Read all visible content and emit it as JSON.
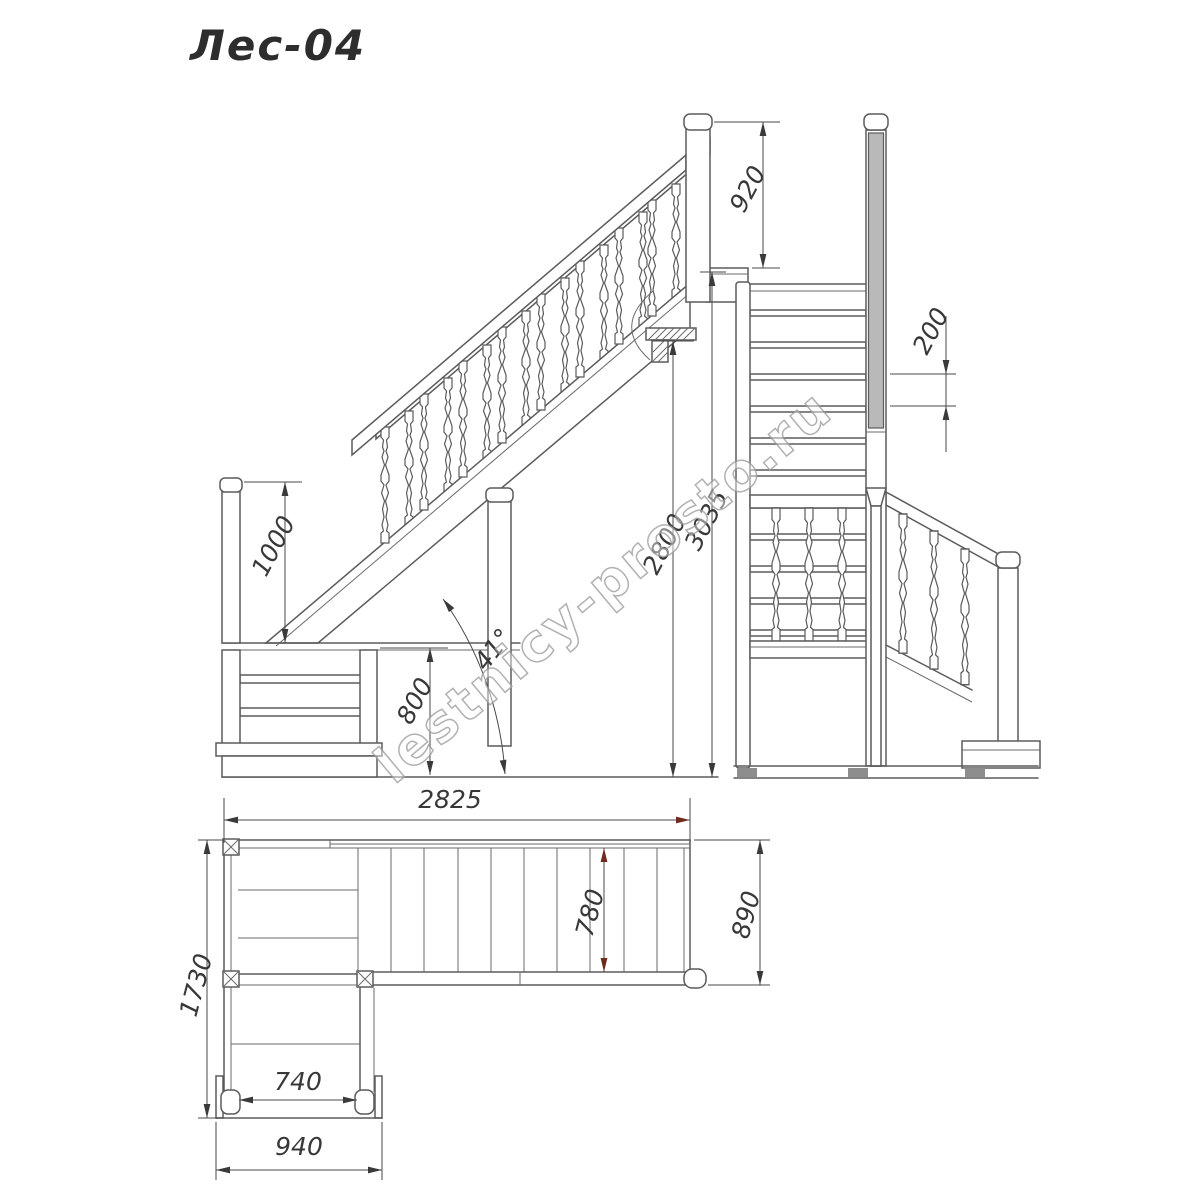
{
  "title": "Лес-04",
  "watermark": "lestnicy-prosto.ru",
  "dims": {
    "run_total": "2825",
    "newel_height": "920",
    "riser": "200",
    "rail_height": "1000",
    "landing_height": "800",
    "floor_clearance": "2800",
    "floor_top": "3035",
    "angle": "41°",
    "plan_depth": "1730",
    "lower_flight_inner": "740",
    "lower_flight_outer": "940",
    "flight_inner": "780",
    "flight_outer": "890"
  },
  "colors": {
    "line": "#5b5b5b",
    "dimension": "#4a4a4a",
    "accent_arrow": "#6f2b1d",
    "watermark": "#9e9e9e"
  }
}
